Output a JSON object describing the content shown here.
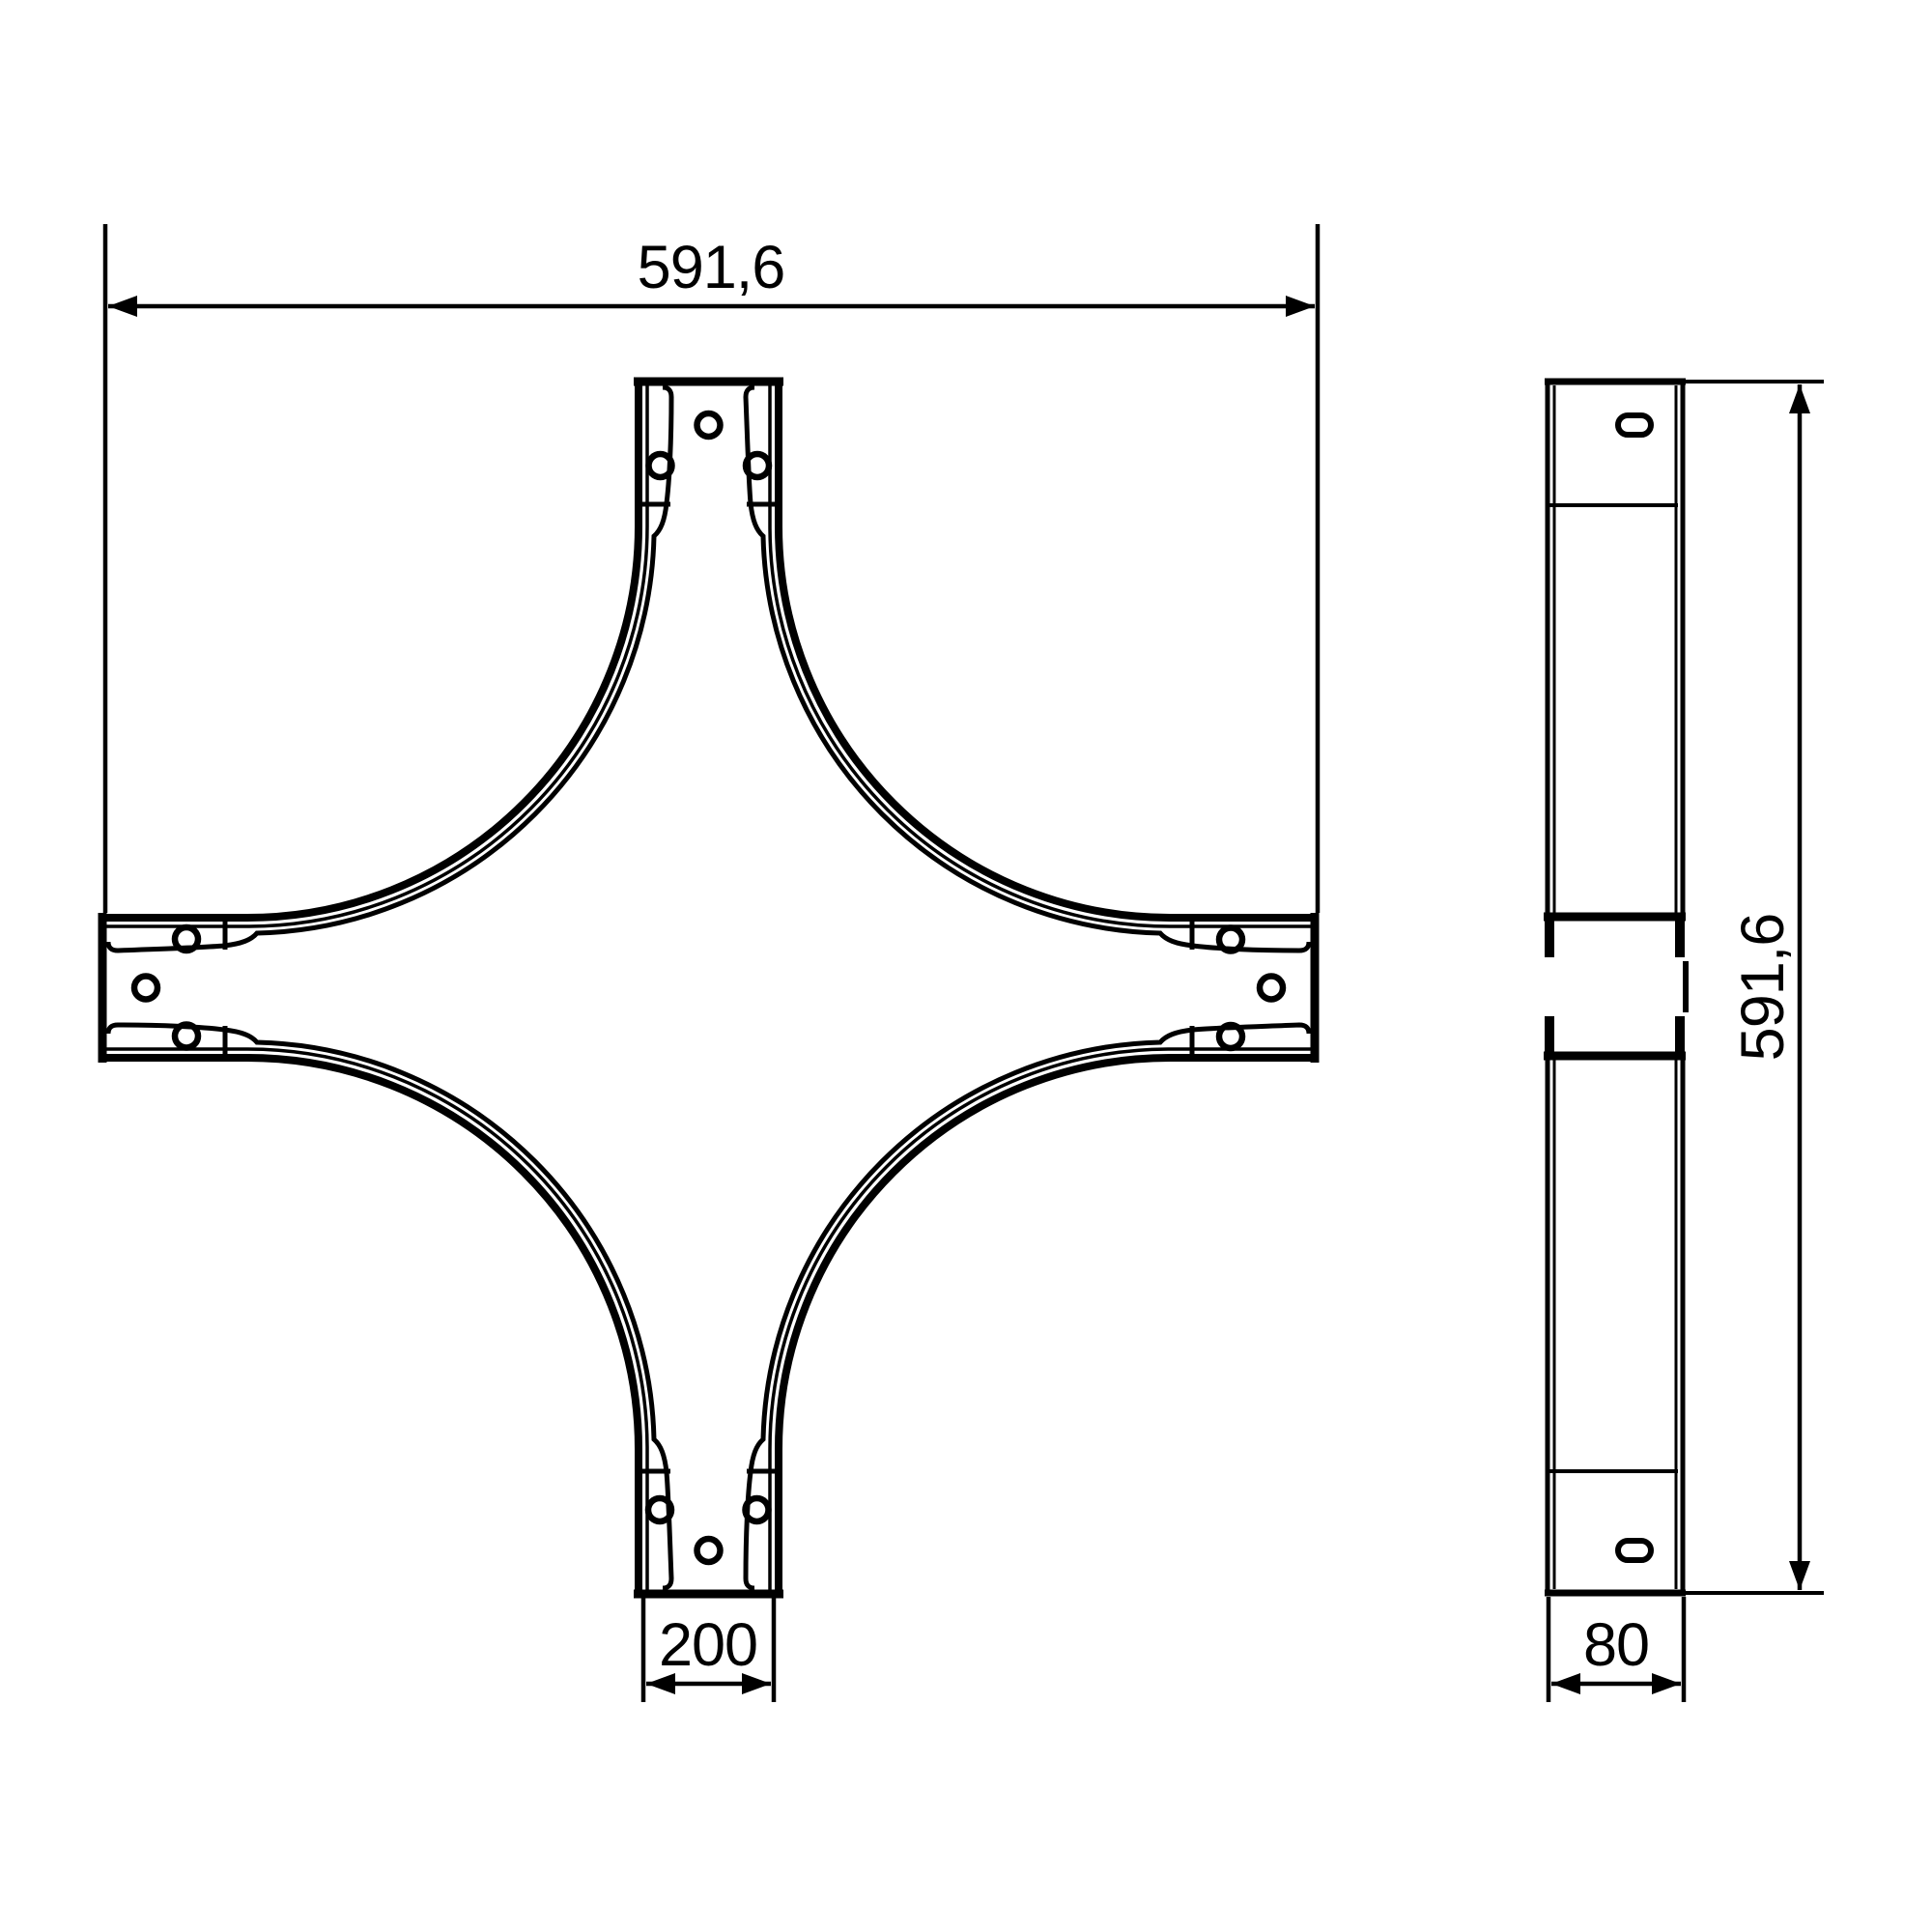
{
  "drawing": {
    "title": "crosspiece-technical-drawing",
    "front_view": {
      "width_dim_label": "591,6",
      "connector_width_dim_label": "200",
      "arm_end_holes_per_arm": 3
    },
    "side_view": {
      "height_dim_label": "591,6",
      "depth_dim_label": "80",
      "slot_holes": 2
    },
    "colors": {
      "line": "#000000",
      "background": "#ffffff"
    }
  }
}
